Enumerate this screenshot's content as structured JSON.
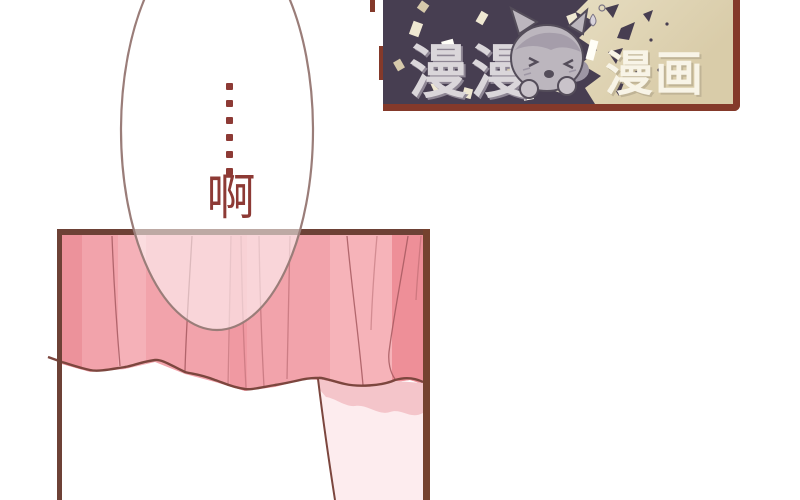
{
  "speech_bubble": {
    "ellipsis": "……",
    "ellipsis_dot_count": 6,
    "word": "啊"
  },
  "logo": {
    "brand_left": "漫漫",
    "brand_right": "漫画",
    "mascot": "chibi-cat-girl"
  },
  "colors": {
    "text_red": "#8d3a35",
    "bubble_outline": "#9a7d79",
    "bubble_fill": "rgba(255,255,255,0.55)",
    "panel_border": "#6d4136",
    "panel_border_right": "#75422f",
    "skirt_base": "#f2a3ab",
    "skirt_dark": "#ec929b",
    "skirt_light": "#f6b6bc",
    "fold_line": "#a65a60",
    "hem_line": "#7c463e",
    "leg_skin": "#fdecee",
    "leg_shadow": "#f4c5ca",
    "banner_purple": "#473e51",
    "banner_cream_1": "#f3edd8",
    "banner_cream_2": "#d9cca9",
    "banner_border": "#84392a",
    "logo_gray_text": "#dad6da",
    "logo_gray_shadow": "#8e8694",
    "logo_cream_text": "#f8f4e7",
    "logo_cream_shadow": "#c0b496"
  }
}
